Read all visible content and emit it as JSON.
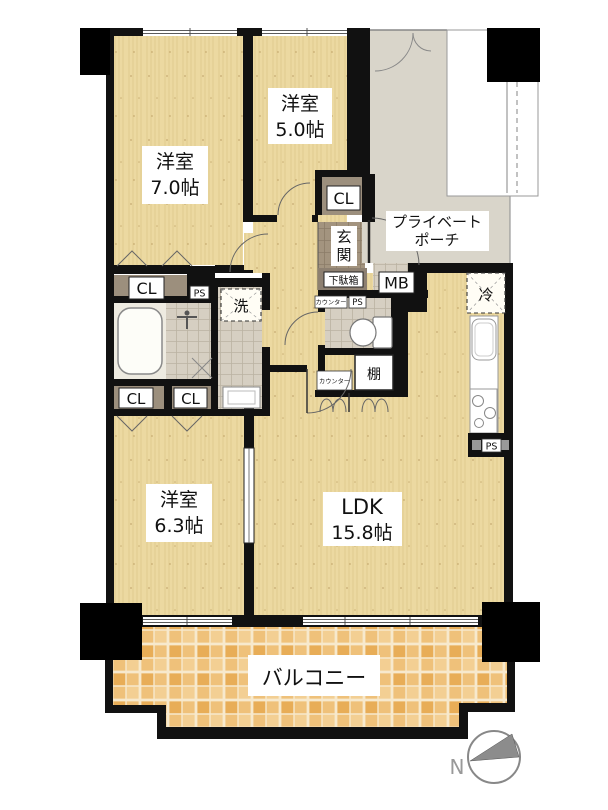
{
  "document_type": "apartment-floor-plan",
  "rooms": {
    "bedroom_7": {
      "name": "洋室",
      "size": "7.0帖"
    },
    "bedroom_5": {
      "name": "洋室",
      "size": "5.0帖"
    },
    "bedroom_63": {
      "name": "洋室",
      "size": "6.3帖"
    },
    "ldk": {
      "name": "LDK",
      "size": "15.8帖"
    },
    "balcony": {
      "name": "バルコニー"
    },
    "porch": {
      "line1": "プライベート",
      "line2": "ポーチ"
    },
    "entrance": {
      "char1": "玄",
      "char2": "関"
    }
  },
  "features": {
    "closet_5room": "CL",
    "closet_hall": "CL",
    "closet_low_left": "CL",
    "closet_low_right": "CL",
    "shoe_cabinet": "下駄箱",
    "meter_box": "MB",
    "ps_hall": "PS",
    "ps_toilet": "PS",
    "ps_kitchen": "PS",
    "fridge": "冷",
    "laundry": "洗",
    "shelf": "棚",
    "counter_toilet": "カウンター",
    "counter_ldk": "カウンター",
    "compass_north": "N"
  },
  "colors": {
    "wall": "#111111",
    "wood_floor": "#ecd9a1",
    "balcony_tile": "#efc17a",
    "porch": "#d9d5ca",
    "wet_area_tile": "#d6cfc2",
    "entrance_tile": "#a3947f",
    "closet_fill": "#9c8f7d",
    "label_bg": "#ffffff",
    "thin_line": "#777777"
  }
}
